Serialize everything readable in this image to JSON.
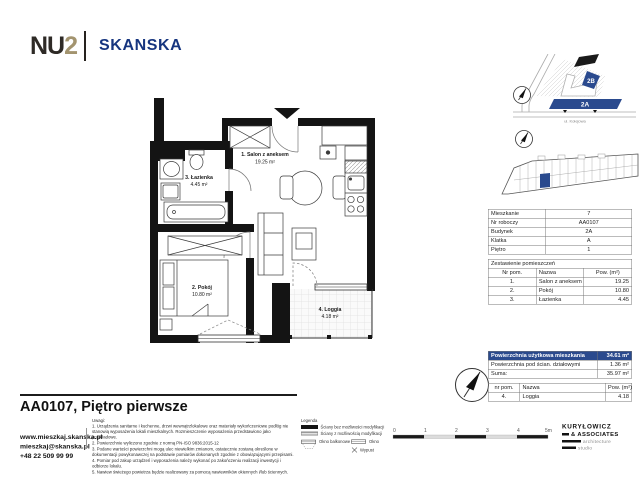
{
  "header": {
    "logo_nu": "NU",
    "logo_2": "2",
    "logo_skanska": "SKANSKA"
  },
  "site_map": {
    "building_2b": "2B",
    "building_2a": "2A",
    "street": "ul. Kolejowa"
  },
  "plan": {
    "salon": {
      "name": "1. Salon z aneksem",
      "area": "19.25 m²"
    },
    "lazienka": {
      "name": "3. Łazienka",
      "area": "4.45 m²"
    },
    "pokoj": {
      "name": "2. Pokój",
      "area": "10.80 m²"
    },
    "loggia": {
      "name": "4. Loggia",
      "area": "4.18 m²"
    }
  },
  "info_table": {
    "rows": [
      {
        "label": "Mieszkanie",
        "value": "7"
      },
      {
        "label": "Nr roboczy",
        "value": "AA0107"
      },
      {
        "label": "Budynek",
        "value": "2A"
      },
      {
        "label": "Klatka",
        "value": "A"
      },
      {
        "label": "Piętro",
        "value": "1"
      }
    ]
  },
  "rooms_table": {
    "title": "Zestawienie pomieszczeń",
    "headers": [
      "Nr pom.",
      "Nazwa",
      "Pow. (m²)"
    ],
    "rows": [
      [
        "1.",
        "Salon z aneksem",
        "19.25"
      ],
      [
        "2.",
        "Pokój",
        "10.80"
      ],
      [
        "3.",
        "Łazienka",
        "4.45"
      ]
    ]
  },
  "area_table": {
    "rows": [
      {
        "label": "Powierzchnia użytkowa mieszkania",
        "value": "34.61 m²"
      },
      {
        "label": "Powierzchnia pod ścian. działowymi",
        "value": "1.36 m²"
      },
      {
        "label": "Suma:",
        "value": "35.97 m²"
      }
    ]
  },
  "loggia_table": {
    "headers": [
      "nr pom.",
      "Nazwa",
      "Pow. (m²)"
    ],
    "rows": [
      [
        "4.",
        "Loggia",
        "4.18"
      ]
    ]
  },
  "footer": {
    "title": "AA0107, Piętro pierwsze",
    "contact": [
      "www.mieszkaj.skanska.pl",
      "mieszkaj@skanska.pl",
      "+48 22 509 99 99"
    ],
    "notes_title": "Uwagi:",
    "notes": [
      "1. Urządzenia sanitarne i kuchenne, drzwi wewnątrzlokalowe oraz materiały wykończeniowe podłóg nie stanowią wyposażenia lokali mieszkalnych. Rozmieszczenie wyposażenia przedstawiono jako przykładowe.",
      "2. Powierzchnie wyliczono zgodnie z normą PN-ISO 9836:2015-12",
      "3. Podane wartości powierzchni mogą ulec niewielkim zmianom, ostatecznie zostaną określone w dokumentacji powykonawczej na podstawie pomiarów dokonanych zgodnie z obowiązującymi przepisami.",
      "4. Pomiar pod zakup urządzeń i wyposażenia należy wykonać po zakończeniu realizacji inwestycji i odbiorze lokalu.",
      "5. Nawiew świeżego powietrza będzie realizowany za pomocą nawiewników okiennych i/lub ściennych."
    ]
  },
  "legend": {
    "title": "Legenda",
    "wall_fixed": "Ściany bez możliwości modyfikacji",
    "wall_mod": "Ściany z możliwością modyfikacji",
    "okno_balkonowe": "Okno balkonowe",
    "okno": "Okno",
    "wypust": "Wypust"
  },
  "scale_bar": {
    "labels": [
      "0",
      "1",
      "2",
      "3",
      "4",
      "5m"
    ]
  },
  "architect": {
    "name": "KURYŁOWICZ",
    "name2": "& ASSOCIATES",
    "sub1": "architecture",
    "sub2": "studio"
  },
  "colors": {
    "navy": "#2a4a8e",
    "skanska_blue": "#16357f",
    "tan": "#a3946f",
    "wall": "#141414"
  }
}
